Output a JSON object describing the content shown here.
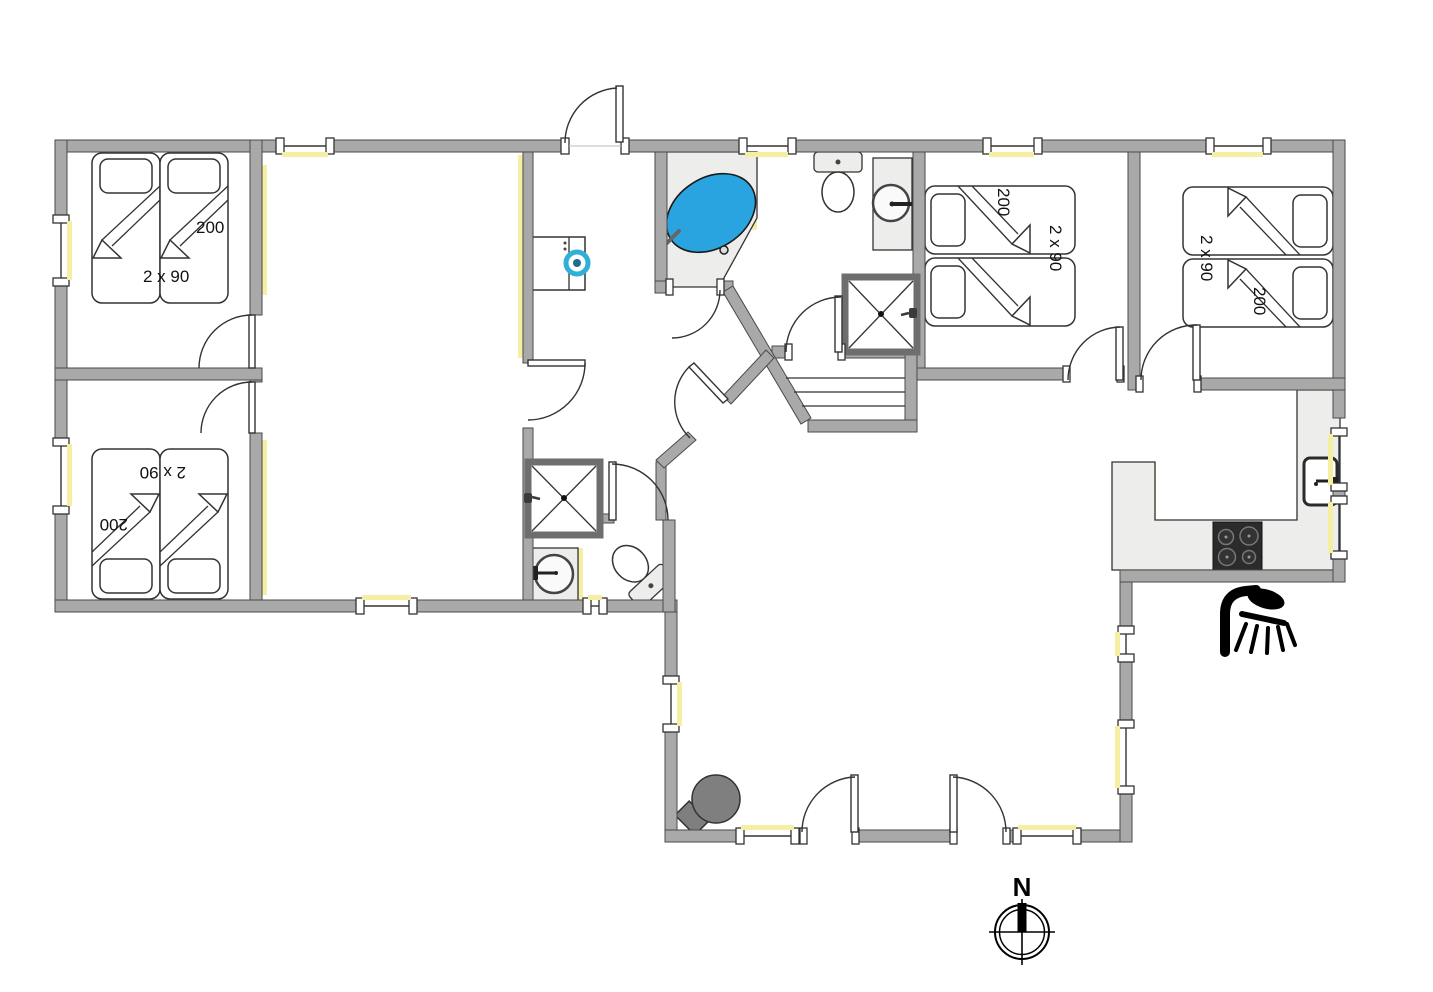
{
  "title": "holiday-house-floor-plan",
  "labels": {
    "bedroom_top_left": {
      "bed_length": "200",
      "bed_width": "2 x 90"
    },
    "bedroom_bottom_left": {
      "bed_length": "200",
      "bed_width": "2 x 90"
    },
    "bedroom_mid_right": {
      "bed_length": "200",
      "bed_width": "2 x 90"
    },
    "bedroom_far_right": {
      "bed_length": "200",
      "bed_width": "2 x 90"
    }
  },
  "compass": {
    "north_label": "N"
  },
  "icons": {
    "outdoor_shower": "outdoor-shower-icon",
    "compass": "compass-rose-icon",
    "bathtub": "corner-jacuzzi-icon",
    "washer": "washing-machine-icon",
    "stove": "cooktop-icon",
    "fireplace": "wood-stove-icon"
  },
  "colors": {
    "wall": "#a9a9a9",
    "wall_edge": "#4a4a4a",
    "fixture": "#ededeb",
    "accent_yellow": "#f4efa2",
    "tub_blue": "#29a4e0",
    "washer_blue": "#2fb0d6",
    "fireplace_gray": "#7f7f7f",
    "line": "#333333",
    "icon_black": "#000000"
  }
}
